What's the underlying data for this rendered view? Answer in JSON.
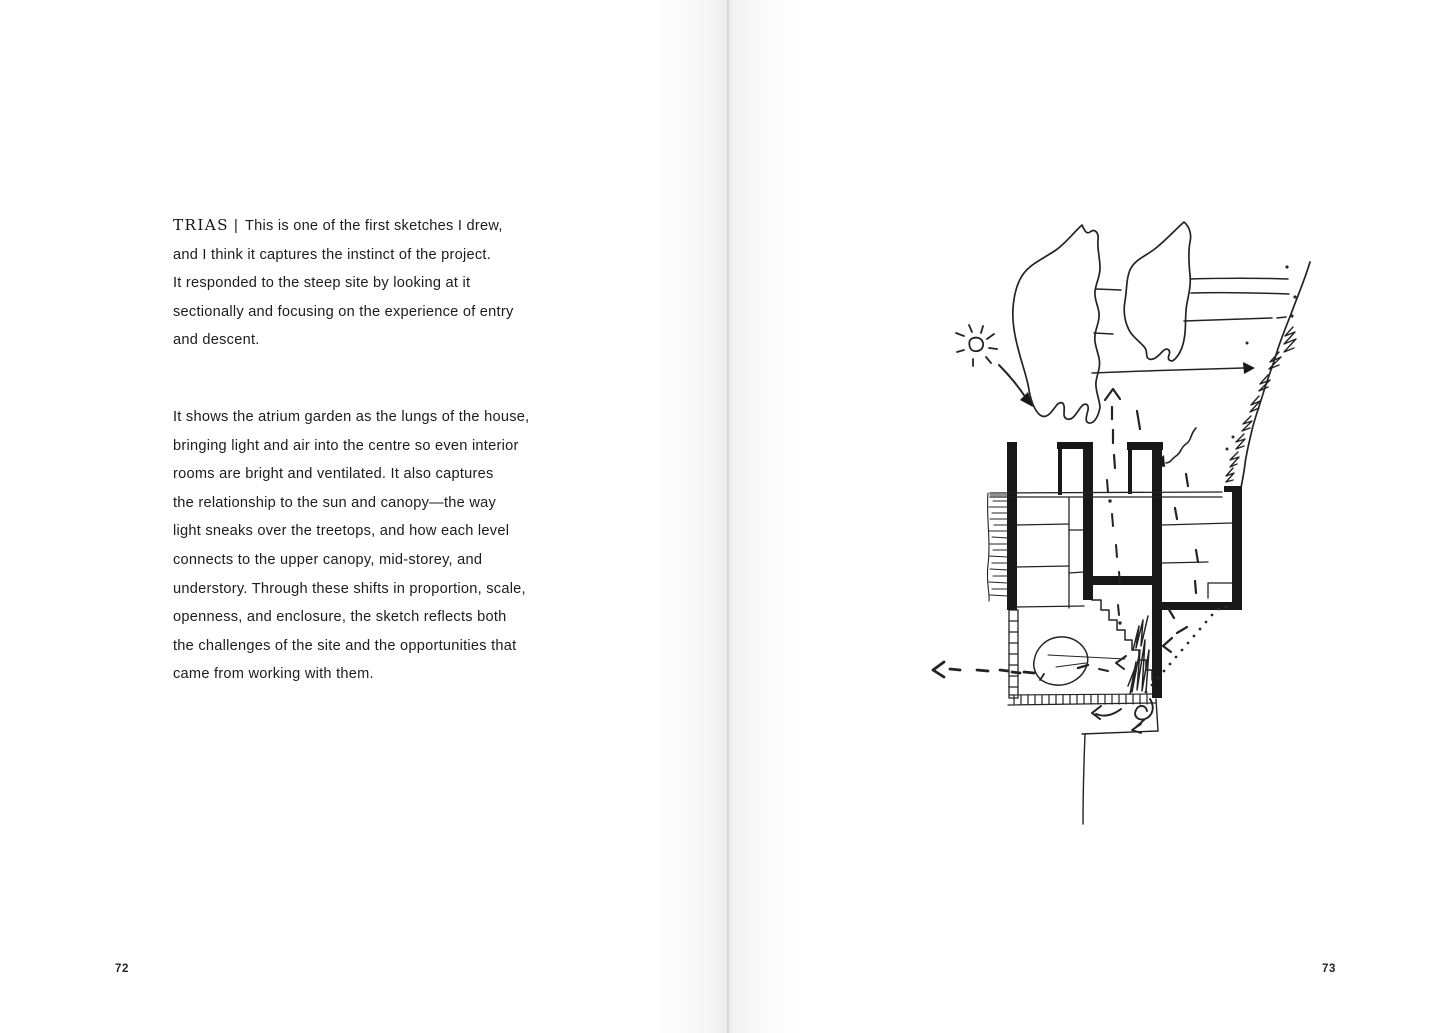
{
  "colors": {
    "paper": "#ffffff",
    "ink": "#1f1f1f",
    "gutter_shadow": "#dedede"
  },
  "left_page": {
    "page_number": "72",
    "paragraph1": {
      "speaker": "TRIAS",
      "separator": "|",
      "lines": [
        "This is one of the first sketches I drew,",
        "and I think it captures the instinct of the project.",
        "It responded to the steep site by looking at it",
        "sectionally and focusing on the experience of entry",
        "and descent."
      ]
    },
    "paragraph2": {
      "lines": [
        "It shows the atrium garden as the lungs of the house,",
        "bringing light and air into the centre so even interior",
        "rooms are bright and ventilated. It also captures",
        "the relationship to the sun and canopy—the way",
        "light sneaks over the treetops, and how each level",
        "connects to the upper canopy, mid-storey, and",
        "understory. Through these shifts in proportion, scale,",
        "openness, and enclosure, the sketch reflects both",
        "the challenges of the site and the opportunities that",
        "came from working with them."
      ]
    }
  },
  "right_page": {
    "page_number": "73"
  }
}
